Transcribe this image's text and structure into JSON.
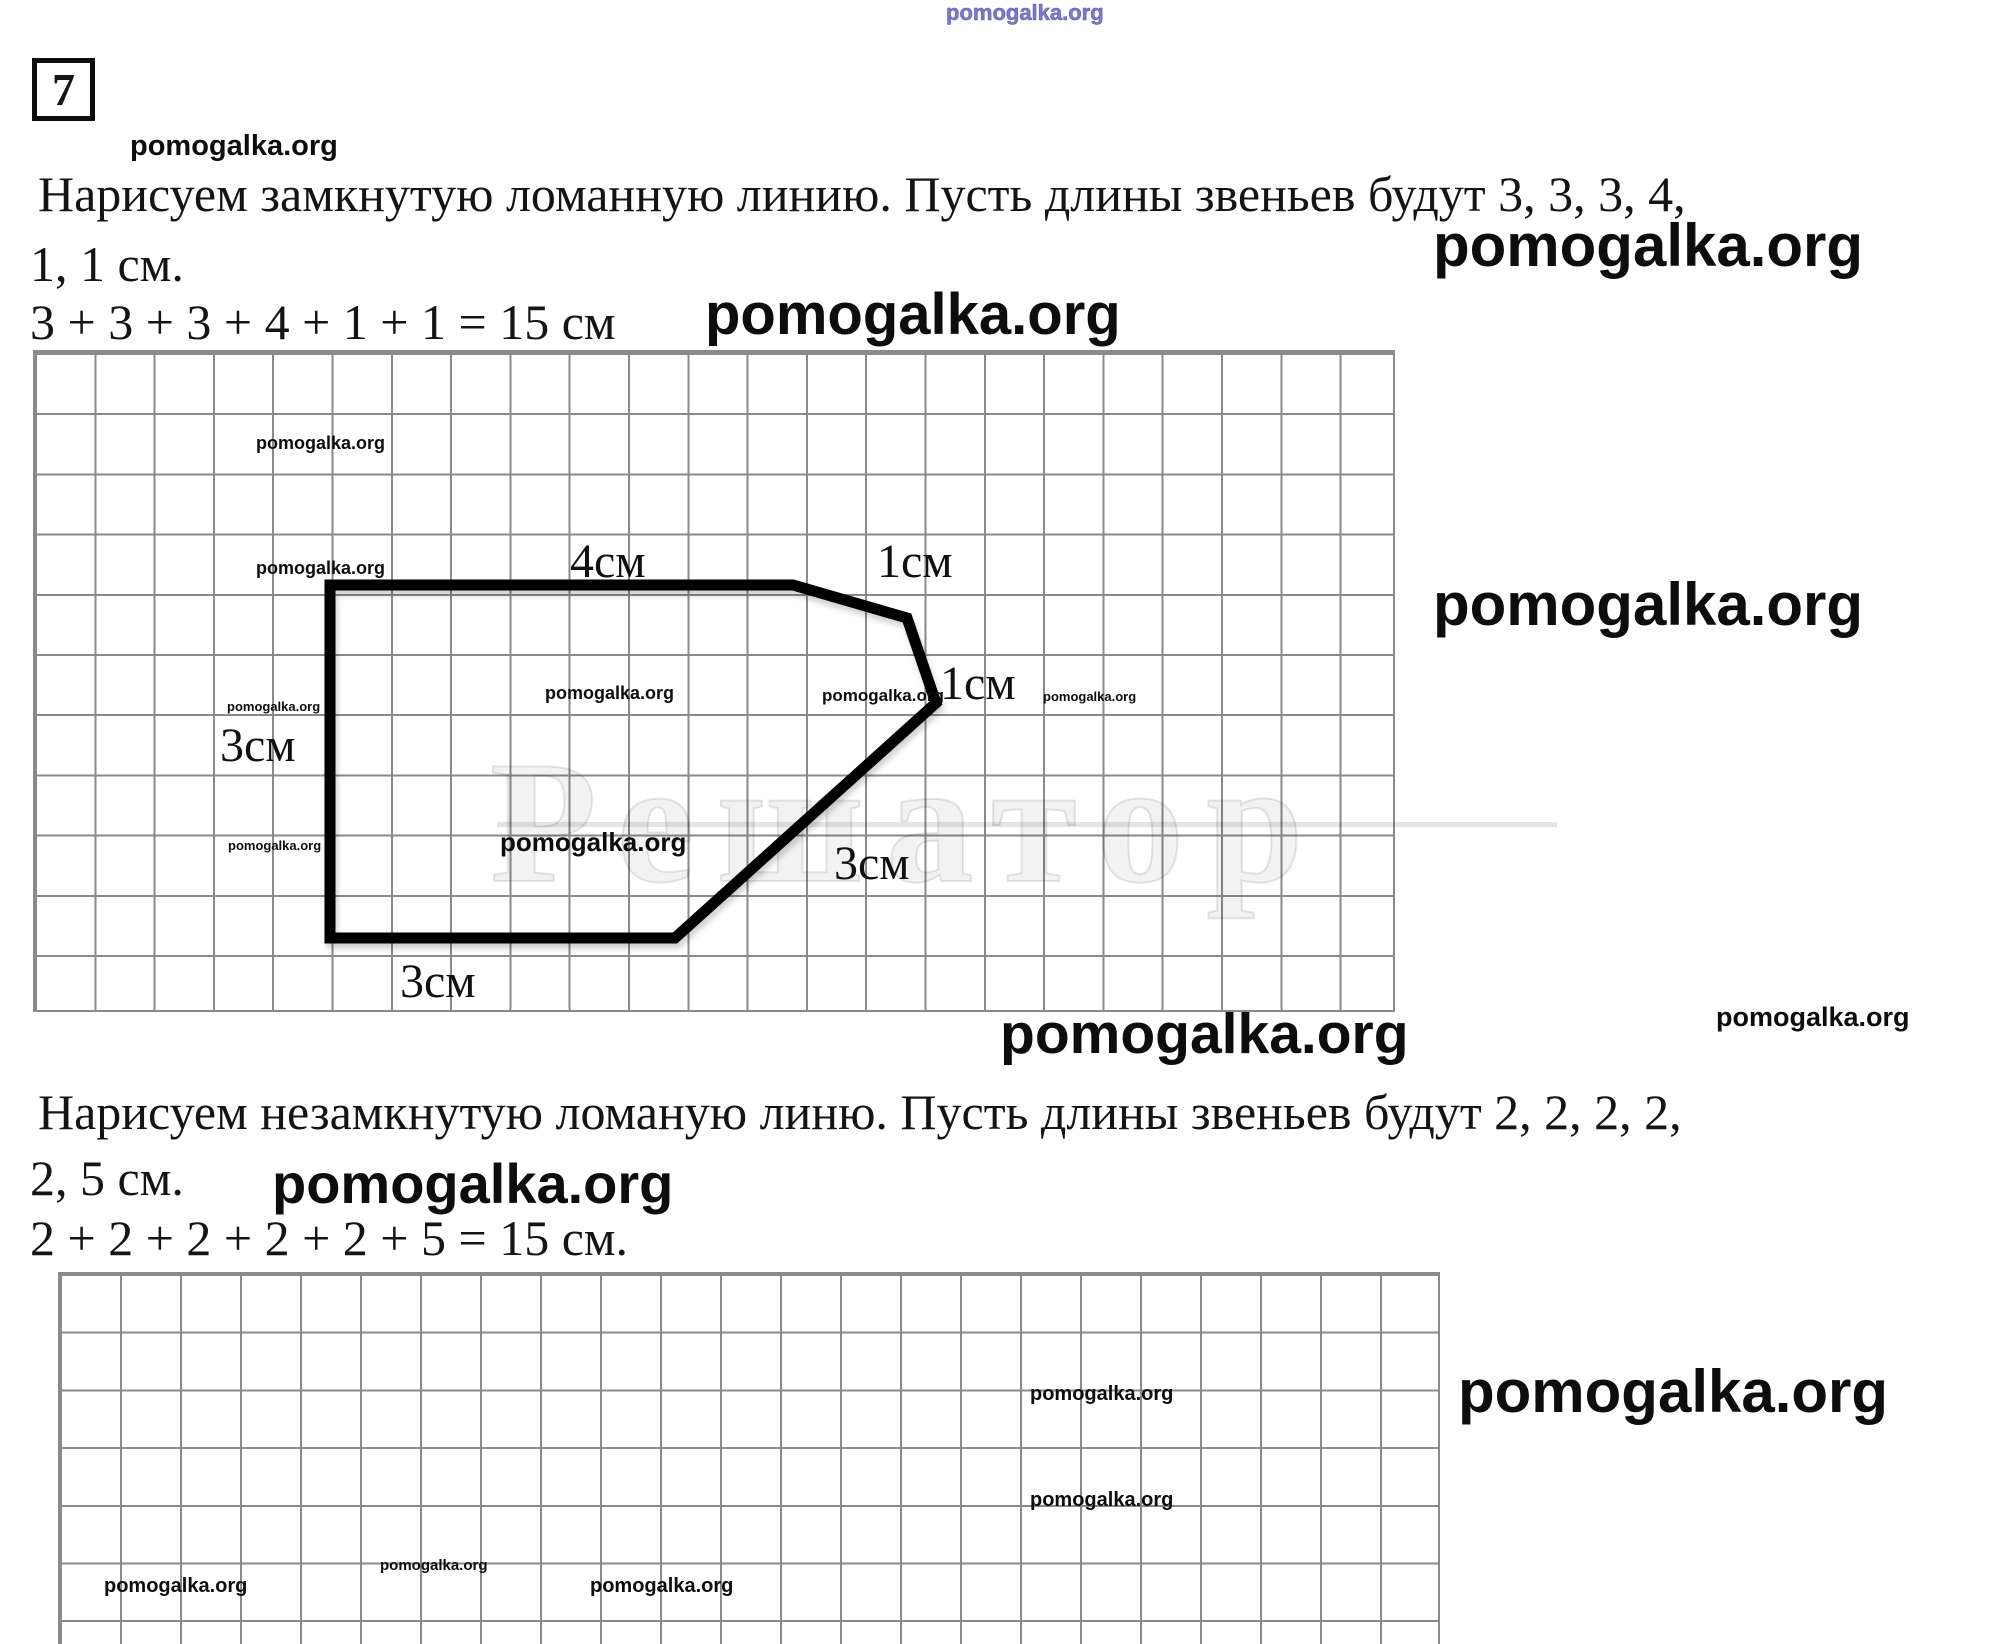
{
  "watermark": {
    "text": "pomogalka.org"
  },
  "ghost": {
    "text": "Решатор"
  },
  "problem": {
    "number": "7"
  },
  "solution1": {
    "line1": "Нарисуем замкнутую ломанную линию. Пусть длины звеньев будут 3, 3, 3, 4,",
    "line2": "1, 1 см.",
    "equation": "3 + 3 + 3 + 4 + 1 + 1 = 15 см"
  },
  "solution2": {
    "line1": "Нарисуем незамкнутую ломаную линю. Пусть длины звеньев будут 2, 2, 2, 2,",
    "line2": "2, 5 см.",
    "equation": "2 + 2 + 2 + 2 + 2 + 5 = 15 см."
  },
  "figure1": {
    "type": "closed-polyline",
    "segment_lengths_cm": [
      3,
      4,
      1,
      1,
      3,
      3
    ],
    "points": "330,585 793,585 907,618 936,703 675,938 330,938",
    "labels": {
      "top": "4см",
      "seg2": "1см",
      "seg3": "1см",
      "left": "3см",
      "diag": "3см",
      "bottom": "3см"
    }
  },
  "figure2": {
    "type": "open-polyline",
    "segment_lengths_cm": [
      2,
      2,
      2,
      2,
      2,
      5
    ],
    "points": "233,1564 233,1327 478,1327 478,1558 718,1558 718,1327 1318,1327"
  },
  "colors": {
    "grid_line": "#8a8a8a",
    "shape_stroke": "#000000",
    "watermark_blue": "#7a7ac8"
  }
}
